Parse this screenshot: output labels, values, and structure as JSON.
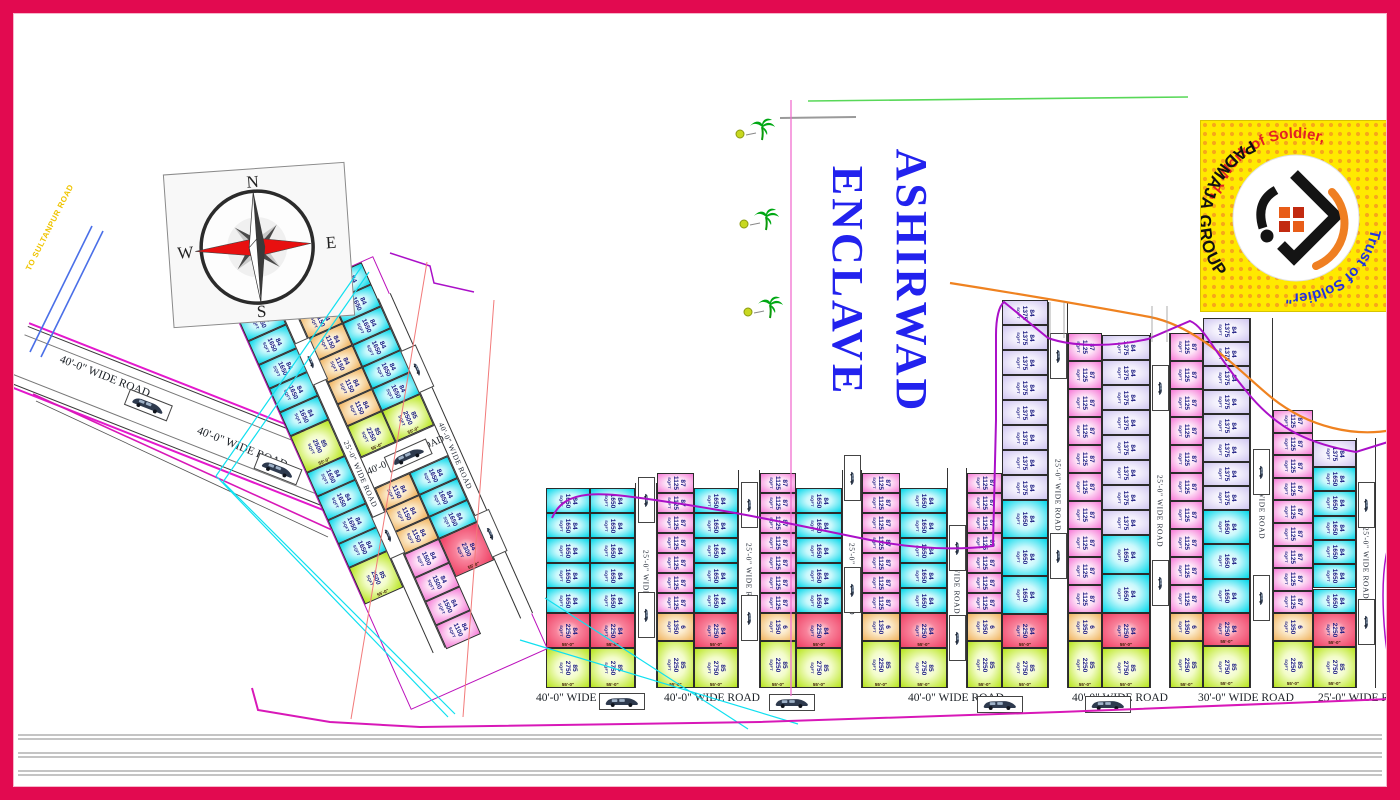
{
  "title": {
    "line1": "ASHIRWAD",
    "line2": "ENCLAVE",
    "color": "#2222EE"
  },
  "compass": {
    "n": "N",
    "e": "E",
    "s": "S",
    "w": "W"
  },
  "access_road": {
    "label": "TO SULTANPUR ROAD"
  },
  "diagonal_road": {
    "label1": "40'-0\" WIDE ROAD",
    "label2": "40'-0\" WIDE ROAD"
  },
  "logo": {
    "arc_top": "\"A Work of Soldier,",
    "arc_bottom": "Trust of Soldier\"",
    "group": "PADMAJA GROUP",
    "arc_top_color": "#E32222",
    "arc_bottom_color": "#2233DD",
    "group_color": "#111111",
    "bg": "#FFE900"
  },
  "colors": {
    "plots": {
      "cyan": [
        "#C9F8FC",
        "#00D7EA"
      ],
      "magenta": [
        "#FDE3F7",
        "#F678D6"
      ],
      "lavender": [
        "#F3F0FC",
        "#CFC5F0"
      ],
      "orange": [
        "#FBEACB",
        "#F0B25C"
      ],
      "red": [
        "#F8829B",
        "#EF3F63"
      ],
      "green": [
        "#F2FCC8",
        "#B7E51A"
      ]
    },
    "boundary_purple": "#AA10C8",
    "utility_orange": "#EF8220",
    "survey_green": "#58D858",
    "drain_cyan": "#10E0F0",
    "frame_crimson": "#E20A50"
  },
  "plots": {
    "unit": "SQFT",
    "dims": {
      "bottom": "55'-0\""
    },
    "v_road_label": "25'-0\" WIDE ROAD",
    "strips": [
      {
        "x": 546,
        "w": 44,
        "top": 488,
        "cells": [
          [
            "84",
            "1650",
            "cyan",
            25,
            5
          ],
          [
            "84",
            "2250",
            "red",
            35,
            1
          ],
          [
            "85",
            "2750",
            "green",
            40,
            1
          ]
        ]
      },
      {
        "x": 590,
        "w": 45,
        "top": 488,
        "cells": [
          [
            "84",
            "1650",
            "cyan",
            25,
            5
          ],
          [
            "84",
            "2250",
            "red",
            35,
            1
          ],
          [
            "85",
            "2750",
            "green",
            40,
            1
          ]
        ]
      },
      {
        "x": 657,
        "w": 37,
        "top": 473,
        "cells": [
          [
            "87",
            "1125",
            "magenta",
            20,
            7
          ],
          [
            "6",
            "1350",
            "orange",
            28,
            1
          ],
          [
            "85",
            "2250",
            "green",
            47,
            1
          ]
        ]
      },
      {
        "x": 694,
        "w": 44,
        "top": 488,
        "cells": [
          [
            "84",
            "1650",
            "cyan",
            25,
            5
          ],
          [
            "84",
            "2250",
            "red",
            35,
            1
          ],
          [
            "85",
            "2750",
            "green",
            40,
            1
          ]
        ]
      },
      {
        "x": 760,
        "w": 36,
        "top": 473,
        "cells": [
          [
            "87",
            "1125",
            "magenta",
            20,
            7
          ],
          [
            "6",
            "1350",
            "orange",
            28,
            1
          ],
          [
            "85",
            "2250",
            "green",
            47,
            1
          ]
        ]
      },
      {
        "x": 796,
        "w": 46,
        "top": 488,
        "cells": [
          [
            "84",
            "1650",
            "cyan",
            25,
            5
          ],
          [
            "84",
            "2250",
            "red",
            35,
            1
          ],
          [
            "85",
            "2750",
            "green",
            40,
            1
          ]
        ]
      },
      {
        "x": 862,
        "w": 38,
        "top": 473,
        "cells": [
          [
            "87",
            "1125",
            "magenta",
            20,
            7
          ],
          [
            "6",
            "1350",
            "orange",
            28,
            1
          ],
          [
            "85",
            "2250",
            "green",
            47,
            1
          ]
        ]
      },
      {
        "x": 900,
        "w": 47,
        "top": 488,
        "cells": [
          [
            "84",
            "1650",
            "cyan",
            25,
            5
          ],
          [
            "84",
            "2250",
            "red",
            35,
            1
          ],
          [
            "85",
            "2750",
            "green",
            40,
            1
          ]
        ]
      },
      {
        "x": 967,
        "w": 35,
        "top": 473,
        "cells": [
          [
            "87",
            "1125",
            "magenta",
            20,
            7
          ],
          [
            "6",
            "1350",
            "orange",
            28,
            1
          ],
          [
            "85",
            "2250",
            "green",
            47,
            1
          ]
        ]
      },
      {
        "x": 1002,
        "w": 46,
        "top": 300,
        "cells": [
          [
            "84",
            "1375",
            "lavender",
            25,
            8
          ],
          [
            "84",
            "1650",
            "cyan",
            38,
            3
          ],
          [
            "84",
            "2250",
            "red",
            34,
            1
          ],
          [
            "85",
            "2750",
            "green",
            40,
            1
          ]
        ]
      },
      {
        "x": 1068,
        "w": 34,
        "top": 333,
        "cells": [
          [
            "87",
            "1125",
            "magenta",
            28,
            10
          ],
          [
            "6",
            "1350",
            "orange",
            28,
            1
          ],
          [
            "85",
            "2250",
            "green",
            47,
            1
          ]
        ]
      },
      {
        "x": 1102,
        "w": 48,
        "top": 335,
        "cells": [
          [
            "84",
            "1375",
            "lavender",
            25,
            8
          ],
          [
            "84",
            "1650",
            "cyan",
            39,
            2
          ],
          [
            "84",
            "2250",
            "red",
            35,
            1
          ],
          [
            "85",
            "2750",
            "green",
            40,
            1
          ]
        ]
      },
      {
        "x": 1170,
        "w": 33,
        "top": 333,
        "cells": [
          [
            "87",
            "1125",
            "magenta",
            28,
            10
          ],
          [
            "6",
            "1350",
            "orange",
            28,
            1
          ],
          [
            "85",
            "2250",
            "green",
            47,
            1
          ]
        ]
      },
      {
        "x": 1203,
        "w": 47,
        "top": 318,
        "cells": [
          [
            "84",
            "1375",
            "lavender",
            24,
            8
          ],
          [
            "84",
            "1650",
            "cyan",
            34.3,
            3
          ],
          [
            "84",
            "2250",
            "red",
            33,
            1
          ],
          [
            "85",
            "2750",
            "green",
            42,
            1
          ]
        ]
      },
      {
        "x": 1273,
        "w": 40,
        "top": 410,
        "cells": [
          [
            "87",
            "1125",
            "magenta",
            22.6,
            9
          ],
          [
            "6",
            "1350",
            "orange",
            28,
            1
          ],
          [
            "85",
            "2250",
            "green",
            46.6,
            1
          ]
        ]
      },
      {
        "x": 1313,
        "w": 43,
        "top": 440,
        "cells": [
          [
            "84",
            "1375",
            "lavender",
            27,
            1
          ],
          [
            "84",
            "1650",
            "cyan",
            24.3,
            6
          ],
          [
            "84",
            "2250",
            "red",
            34,
            1
          ],
          [
            "85",
            "2750",
            "green",
            41,
            1
          ]
        ]
      }
    ],
    "v_roads": [
      {
        "x": 635,
        "w": 22,
        "top": 483,
        "bottom": 688,
        "label": "25'-0\" WIDE ROAD",
        "cars": [
          500,
          615
        ]
      },
      {
        "x": 738,
        "w": 22,
        "top": 470,
        "bottom": 688,
        "label": "25'-0\" WIDE ROAD",
        "cars": [
          505,
          618
        ]
      },
      {
        "x": 842,
        "w": 20,
        "top": 470,
        "bottom": 688,
        "label": "25'-0\" WIDE ROAD",
        "cars": [
          478,
          590
        ]
      },
      {
        "x": 947,
        "w": 20,
        "top": 468,
        "bottom": 688,
        "label": "25'-0\" WIDE ROAD",
        "cars": [
          548,
          638
        ]
      },
      {
        "x": 1048,
        "w": 20,
        "top": 302,
        "bottom": 688,
        "label": "25'-0\" WIDE ROAD",
        "cars": [
          356,
          556
        ]
      },
      {
        "x": 1150,
        "w": 20,
        "top": 333,
        "bottom": 688,
        "label": "25'-0\" WIDE ROAD",
        "cars": [
          388,
          583
        ]
      },
      {
        "x": 1250,
        "w": 23,
        "top": 318,
        "bottom": 688,
        "label": "25'-0\" WIDE ROAD",
        "cars": [
          472,
          598
        ]
      },
      {
        "x": 1356,
        "w": 20,
        "top": 438,
        "bottom": 688,
        "label": "25'-0\" WIDE ROAD",
        "cars": [
          505,
          622
        ]
      }
    ],
    "bottom_roads": [
      {
        "x": 536,
        "label": "40'-0\" WIDE ROAD"
      },
      {
        "x": 664,
        "label": "40'-0\" WIDE ROAD"
      },
      {
        "x": 908,
        "label": "40'-0\" WIDE ROAD"
      },
      {
        "x": 1072,
        "label": "40'-0\" WIDE ROAD"
      },
      {
        "x": 1198,
        "label": "30'-0\" WIDE ROAD"
      },
      {
        "x": 1318,
        "label": "25'-0\" WIDE ROAD"
      }
    ],
    "bottom_cars": [
      [
        622,
        701
      ],
      [
        792,
        702
      ],
      [
        1000,
        704
      ],
      [
        1108,
        704
      ]
    ],
    "cluster": {
      "left": 317,
      "top": 268,
      "w": 150,
      "h": 430,
      "rotate": -24,
      "strips": [
        {
          "x": 0,
          "w": 42,
          "top": 0,
          "cells": [
            [
              "84",
              "1650",
              "cyan",
              26,
              5
            ],
            [
              "85",
              "2500",
              "green",
              40,
              1
            ],
            [
              "84",
              "1650",
              "cyan",
              26,
              4
            ],
            [
              "85",
              "2500",
              "green",
              40,
              1
            ]
          ]
        },
        {
          "x": 56,
          "w": 38,
          "top": 0,
          "cells": [
            [
              "84",
              "1150",
              "orange",
              24,
              6
            ],
            [
              "85",
              "2250",
              "green",
              34,
              1
            ]
          ]
        },
        {
          "x": 56,
          "w": 38,
          "top": 212,
          "cells": [
            [
              "84",
              "1150",
              "orange",
              24,
              3
            ],
            [
              "84",
              "1500",
              "magenta",
              26,
              3
            ],
            [
              "84",
              "1100",
              "magenta",
              26,
              1
            ]
          ]
        },
        {
          "x": 94,
          "w": 42,
          "top": 0,
          "cells": [
            [
              "84",
              "1650",
              "cyan",
              24,
              6
            ],
            [
              "85",
              "2500",
              "green",
              34,
              1
            ]
          ]
        },
        {
          "x": 94,
          "w": 42,
          "top": 212,
          "cells": [
            [
              "84",
              "1650",
              "cyan",
              24,
              3
            ],
            [
              "84",
              "2300",
              "red",
              42,
              1
            ]
          ]
        }
      ],
      "v_roads": [
        {
          "x": 42,
          "w": 14,
          "top": 0,
          "bottom": 386,
          "label": "25'-0\" WIDE ROAD",
          "cars": [
            70,
            260
          ]
        },
        {
          "x": 136,
          "w": 14,
          "top": 40,
          "bottom": 390,
          "label": "40'-0\" WIDE ROAD",
          "cars": [
            120,
            300
          ]
        }
      ],
      "h_road": {
        "x": 42,
        "w": 108,
        "y": 178,
        "h": 34,
        "label": "40'-0\" WIDE ROAD",
        "car": [
          100,
          195
        ]
      }
    }
  }
}
